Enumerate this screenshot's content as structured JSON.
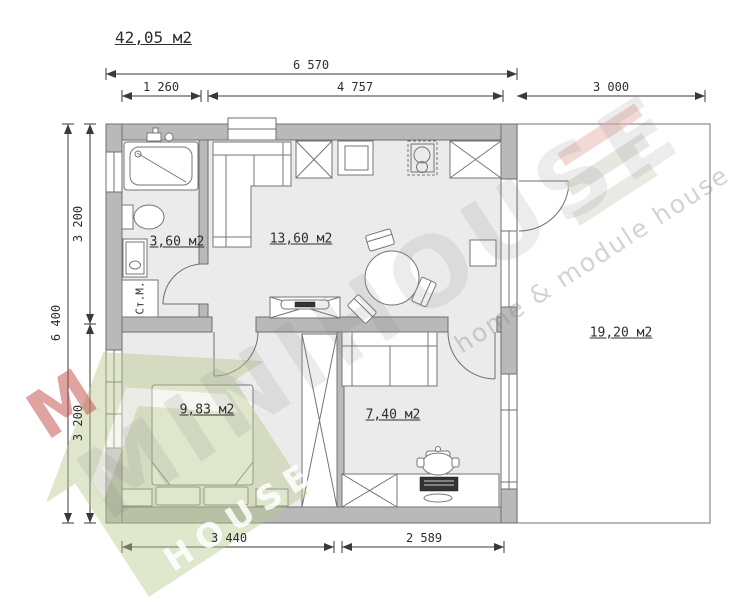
{
  "title": "42,05 м2",
  "dimensions": {
    "top_total": "6 570",
    "top_left": "1 260",
    "top_mid": "4 757",
    "top_right": "3 000",
    "side_total": "6 400",
    "side_upper": "3 200",
    "side_lower": "3 200",
    "bottom_left": "3 440",
    "bottom_right": "2 589"
  },
  "rooms": {
    "bathroom_area": "3,60 м2",
    "living_area": "13,60 м2",
    "bedroom_area": "9,83 м2",
    "office_area": "7,40 м2",
    "terrace_area": "19,20 м2"
  },
  "fixtures": {
    "washing_machine": "Ст.М."
  },
  "watermark": {
    "brand": "MINIHOUSE",
    "tagline": "home & module house",
    "logo_word": "HOUSE",
    "logo_letter": "M"
  },
  "colors": {
    "wall_fill": "#b9b9b9",
    "floor_fill": "#ebebeb",
    "outline": "#6f6f6f",
    "dim_line": "#3a3a3a",
    "logo_green": "#bcc893",
    "logo_red": "#c04a46",
    "logo_pink_bar": "#e8b9b4"
  }
}
